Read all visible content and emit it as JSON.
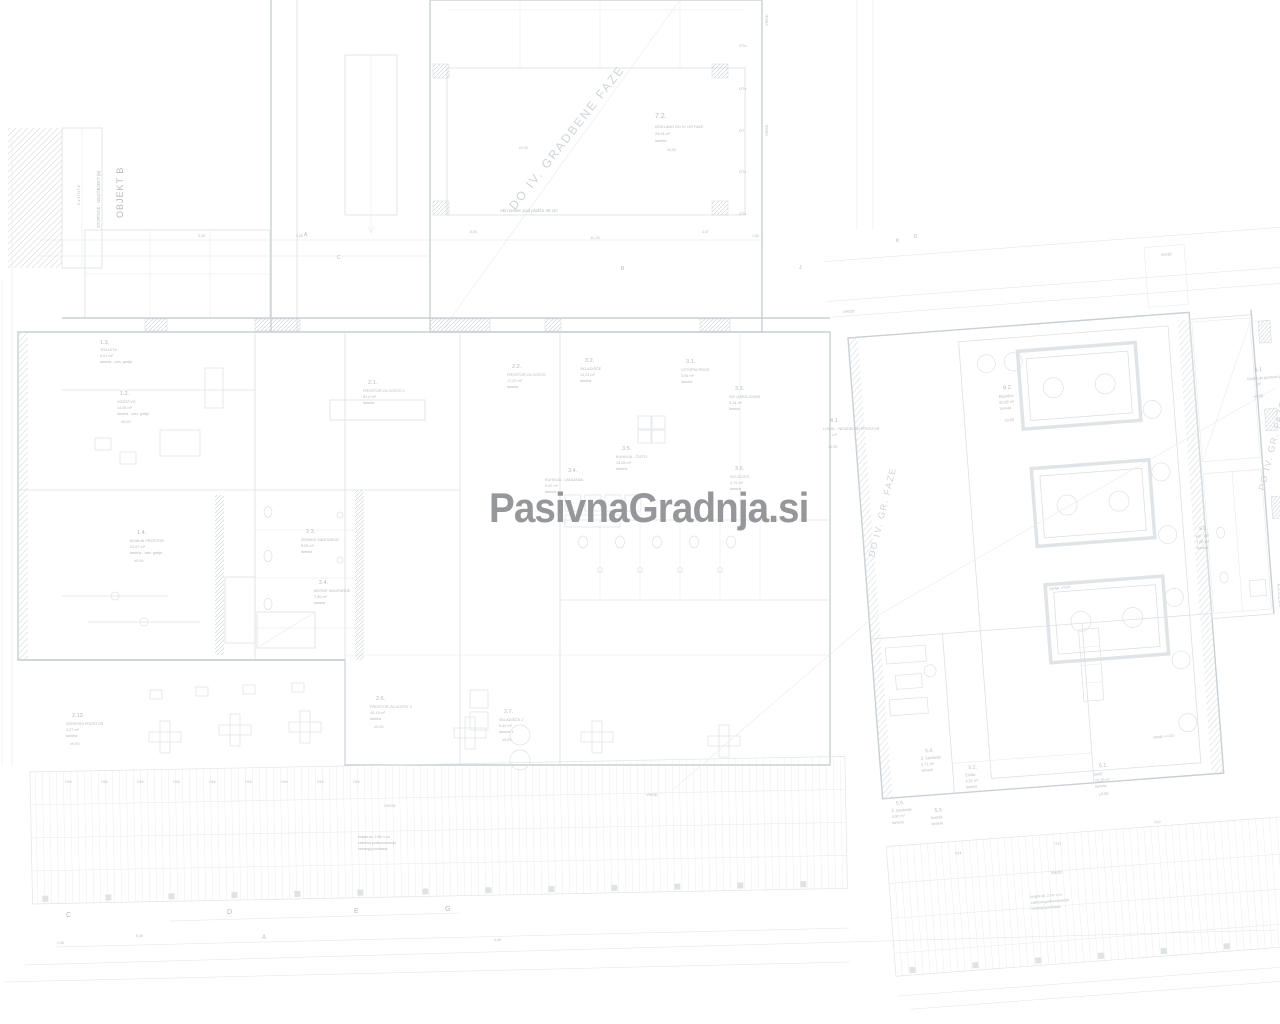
{
  "watermark": {
    "text": "PasivnaGradnja.si",
    "color": "#95979a"
  },
  "plan": {
    "background_color": "#ffffff",
    "wall_color": "#c9cfd4",
    "partition_color": "#dbe0e4",
    "label_color": "#b4bac0",
    "phase_text_color": "#ced4d9",
    "labels": [
      {
        "t": "OBJEKT B",
        "x": 123,
        "y": 218,
        "s": 9,
        "r": -90,
        "w": 1
      },
      {
        "t": "STOPNICE - OBJ/OBJEKT (B)",
        "x": 100,
        "y": 228,
        "s": 4.2,
        "r": -90
      },
      {
        "t": "9 x 17/17,8",
        "x": 80,
        "y": 205,
        "s": 4,
        "r": -90
      },
      {
        "t": "DO IV. GRADBENE FAZE",
        "x": 570,
        "y": 140,
        "s": 12,
        "r": -52,
        "c": "#ced4d9",
        "w": 2,
        "a": "middle"
      },
      {
        "t": "7.2.",
        "x": 655,
        "y": 118,
        "s": 7
      },
      {
        "t": "IZDELANO DO IV. GR FAZE",
        "x": 655,
        "y": 128
      },
      {
        "t": "29,04 m²",
        "x": 655,
        "y": 135
      },
      {
        "t": "lamela",
        "x": 655,
        "y": 142
      },
      {
        "t": "AB nosilec pod ploščo 45 cm",
        "x": 500,
        "y": 212,
        "s": 4.5
      },
      {
        "t": "11,15",
        "x": 590,
        "y": 239,
        "s": 4
      },
      {
        "t": "5,00",
        "x": 470,
        "y": 233,
        "s": 3.5
      },
      {
        "t": "4,67",
        "x": 702,
        "y": 233,
        "s": 3.5
      },
      {
        "t": "1,50",
        "x": 752,
        "y": 237,
        "s": 3.5
      },
      {
        "t": "3,08",
        "x": 296,
        "y": 237,
        "s": 3.5
      },
      {
        "t": "2,30",
        "x": 198,
        "y": 237,
        "s": 3.5
      },
      {
        "t": "±0,00",
        "x": 519,
        "y": 149,
        "s": 3.5
      },
      {
        "t": "±0,00",
        "x": 667,
        "y": 151,
        "s": 3.5
      },
      {
        "t": "O7s",
        "x": 739,
        "y": 47,
        "s": 4
      },
      {
        "t": "O7s",
        "x": 739,
        "y": 90,
        "s": 4
      },
      {
        "t": "O7",
        "x": 739,
        "y": 132,
        "s": 4
      },
      {
        "t": "O7s",
        "x": 739,
        "y": 173,
        "s": 4
      },
      {
        "t": "O7s",
        "x": 739,
        "y": 215,
        "s": 4
      },
      {
        "t": "VHOD",
        "x": 768,
        "y": 26,
        "s": 4,
        "r": -90
      },
      {
        "t": "VHOD",
        "x": 768,
        "y": 136,
        "s": 4,
        "r": -90
      },
      {
        "t": "A",
        "x": 304,
        "y": 236,
        "s": 5
      },
      {
        "t": "C",
        "x": 337,
        "y": 259,
        "s": 5
      },
      {
        "t": "B",
        "x": 621,
        "y": 270,
        "s": 5
      },
      {
        "t": "J",
        "x": 799,
        "y": 269,
        "s": 5
      },
      {
        "t": "1.3.",
        "x": 100,
        "y": 344,
        "s": 5.5
      },
      {
        "t": "TOALETA",
        "x": 100,
        "y": 351
      },
      {
        "t": "5,01 m²",
        "x": 100,
        "y": 357
      },
      {
        "t": "lamela - taln. gretje",
        "x": 100,
        "y": 363
      },
      {
        "t": "1.2.",
        "x": 120,
        "y": 395,
        "s": 5.5
      },
      {
        "t": "VODSTVO",
        "x": 117,
        "y": 403
      },
      {
        "t": "14,05 m²",
        "x": 117,
        "y": 409
      },
      {
        "t": "lamela - taln. gretje",
        "x": 117,
        "y": 415
      },
      {
        "t": "±0,00",
        "x": 121,
        "y": 423
      },
      {
        "t": "2.1.",
        "x": 368,
        "y": 384,
        "s": 5.5
      },
      {
        "t": "PROSTOR ZA GOSTE 1",
        "x": 363,
        "y": 392
      },
      {
        "t": "81,9 m²",
        "x": 363,
        "y": 398
      },
      {
        "t": "lamela",
        "x": 363,
        "y": 404
      },
      {
        "t": "2.2.",
        "x": 512,
        "y": 368,
        "s": 5.5
      },
      {
        "t": "PROSTOR ZA GOSTE",
        "x": 507,
        "y": 376
      },
      {
        "t": "17,22 m²",
        "x": 507,
        "y": 382
      },
      {
        "t": "lamela",
        "x": 507,
        "y": 388
      },
      {
        "t": "1.4.",
        "x": 137,
        "y": 534,
        "s": 5.5
      },
      {
        "t": "BIVALNI PROSTOR",
        "x": 130,
        "y": 542
      },
      {
        "t": "22,67 m²",
        "x": 130,
        "y": 548
      },
      {
        "t": "lamela - taln. gretje",
        "x": 130,
        "y": 554
      },
      {
        "t": "±0,00",
        "x": 134,
        "y": 562
      },
      {
        "t": "2.3.",
        "x": 306,
        "y": 533,
        "s": 5.5
      },
      {
        "t": "ŽENSKE SANITARIJE",
        "x": 301,
        "y": 541
      },
      {
        "t": "8,05 m²",
        "x": 301,
        "y": 547
      },
      {
        "t": "lamela",
        "x": 301,
        "y": 553
      },
      {
        "t": "2.4.",
        "x": 319,
        "y": 584,
        "s": 5.5
      },
      {
        "t": "MOŠKE SANITARIJE",
        "x": 314,
        "y": 592
      },
      {
        "t": "7,50 m²",
        "x": 314,
        "y": 598
      },
      {
        "t": "lamela",
        "x": 314,
        "y": 604
      },
      {
        "t": "3.2.",
        "x": 585,
        "y": 362,
        "s": 5.5
      },
      {
        "t": "SKLADIŠČE",
        "x": 580,
        "y": 370
      },
      {
        "t": "12,21 m²",
        "x": 580,
        "y": 376
      },
      {
        "t": "lamela",
        "x": 580,
        "y": 382
      },
      {
        "t": "3.1.",
        "x": 686,
        "y": 363,
        "s": 5.5
      },
      {
        "t": "VSTOPNI PROS.",
        "x": 681,
        "y": 371
      },
      {
        "t": "3,06 m²",
        "x": 681,
        "y": 377
      },
      {
        "t": "lamela",
        "x": 681,
        "y": 383
      },
      {
        "t": "3.3.",
        "x": 735,
        "y": 390,
        "s": 5.5
      },
      {
        "t": "WC GARD./OSEB.",
        "x": 729,
        "y": 398
      },
      {
        "t": "3,14 m²",
        "x": 729,
        "y": 404
      },
      {
        "t": "lamela",
        "x": 729,
        "y": 410
      },
      {
        "t": "3.5.",
        "x": 622,
        "y": 450,
        "s": 5.5
      },
      {
        "t": "KUHINJA - ČISTO",
        "x": 616,
        "y": 458
      },
      {
        "t": "13,05 m²",
        "x": 616,
        "y": 464
      },
      {
        "t": "lamela",
        "x": 616,
        "y": 470
      },
      {
        "t": "3.4.",
        "x": 568,
        "y": 472,
        "s": 5.5
      },
      {
        "t": "KUHINJA - UMAZANA",
        "x": 545,
        "y": 481
      },
      {
        "t": "9,42 m²",
        "x": 545,
        "y": 487
      },
      {
        "t": "lamela",
        "x": 545,
        "y": 493
      },
      {
        "t": "3.6.",
        "x": 735,
        "y": 470,
        "s": 5.5
      },
      {
        "t": "WC-GOSTI",
        "x": 730,
        "y": 478
      },
      {
        "t": "4,70 m²",
        "x": 730,
        "y": 484
      },
      {
        "t": "lamela",
        "x": 730,
        "y": 490
      },
      {
        "t": "4.1.",
        "x": 830,
        "y": 422,
        "s": 5.5
      },
      {
        "t": "LOKAL - NEIZDELAN PROSTOR",
        "x": 823,
        "y": 430
      },
      {
        "t": "- m²",
        "x": 830,
        "y": 436
      },
      {
        "t": "±0,00",
        "x": 828,
        "y": 448
      },
      {
        "t": "2.6.",
        "x": 376,
        "y": 700,
        "s": 5.5
      },
      {
        "t": "PROSTOR ZA GOSTE 2",
        "x": 370,
        "y": 708
      },
      {
        "t": "40,13 m²",
        "x": 370,
        "y": 714
      },
      {
        "t": "lamela",
        "x": 370,
        "y": 720
      },
      {
        "t": "±0,00",
        "x": 374,
        "y": 728
      },
      {
        "t": "2.7.",
        "x": 504,
        "y": 713,
        "s": 5.5
      },
      {
        "t": "SKLADIŠČE 2",
        "x": 499,
        "y": 721
      },
      {
        "t": "5,42 m²",
        "x": 499,
        "y": 727
      },
      {
        "t": "lamela 1",
        "x": 499,
        "y": 733
      },
      {
        "t": "±0,00",
        "x": 502,
        "y": 741
      },
      {
        "t": "2.13.",
        "x": 72,
        "y": 717,
        "s": 5.5
      },
      {
        "t": "SERVISNI PROSTOR",
        "x": 66,
        "y": 725
      },
      {
        "t": "4,27 m²",
        "x": 66,
        "y": 731
      },
      {
        "t": "lamela",
        "x": 66,
        "y": 737
      },
      {
        "t": "±0,00",
        "x": 70,
        "y": 745
      },
      {
        "t": "VHOD",
        "x": 384,
        "y": 807,
        "s": 4
      },
      {
        "t": "VHOD",
        "x": 646,
        "y": 796,
        "s": 4
      },
      {
        "t": "O16",
        "x": 65,
        "y": 783,
        "s": 3.5
      },
      {
        "t": "O15",
        "x": 101,
        "y": 783,
        "s": 3.5
      },
      {
        "t": "O16",
        "x": 137,
        "y": 783,
        "s": 3.5
      },
      {
        "t": "O16",
        "x": 173,
        "y": 783,
        "s": 3.5
      },
      {
        "t": "O15",
        "x": 209,
        "y": 783,
        "s": 3.5
      },
      {
        "t": "O16",
        "x": 245,
        "y": 783,
        "s": 3.5
      },
      {
        "t": "O15",
        "x": 281,
        "y": 783,
        "s": 3.5
      },
      {
        "t": "O16",
        "x": 317,
        "y": 783,
        "s": 3.5
      },
      {
        "t": "O16",
        "x": 353,
        "y": 783,
        "s": 3.5
      },
      {
        "t": "brajda ob. 2,5m v os",
        "x": 358,
        "y": 838,
        "s": 3.5
      },
      {
        "t": "zaščitna podkonstrukcija",
        "x": 358,
        "y": 844,
        "s": 3.5
      },
      {
        "t": "vetrangl pocinkana",
        "x": 358,
        "y": 850,
        "s": 3.5
      },
      {
        "t": "C",
        "x": 66,
        "y": 917,
        "s": 7
      },
      {
        "t": "D",
        "x": 227,
        "y": 914,
        "s": 7
      },
      {
        "t": "E",
        "x": 354,
        "y": 913,
        "s": 7
      },
      {
        "t": "G",
        "x": 445,
        "y": 911,
        "s": 7
      },
      {
        "t": "A",
        "x": 262,
        "y": 939,
        "s": 6
      },
      {
        "t": "4,40",
        "x": 494,
        "y": 941,
        "s": 3.5
      },
      {
        "t": "1,35",
        "x": 57,
        "y": 944,
        "s": 3.5
      },
      {
        "t": "5,45",
        "x": 136,
        "y": 937,
        "s": 3.5
      },
      {
        "t": "9.2.",
        "x": 999,
        "y": 401,
        "s": 5.5,
        "g": "r"
      },
      {
        "t": "Biljardna",
        "x": 994,
        "y": 409,
        "g": "r"
      },
      {
        "t": "60,65 m²",
        "x": 994,
        "y": 415,
        "g": "r"
      },
      {
        "t": "lamela",
        "x": 994,
        "y": 421,
        "g": "r"
      },
      {
        "t": "±0,00",
        "x": 998,
        "y": 433,
        "g": "r"
      },
      {
        "t": "6.1",
        "x": 1251,
        "y": 402,
        "s": 5.5,
        "g": "r"
      },
      {
        "t": "Gostinski poslovni pr.",
        "x": 1243,
        "y": 410,
        "g": "r"
      },
      {
        "t": "- m²",
        "x": 1250,
        "y": 416,
        "g": "r"
      },
      {
        "t": "±0,00",
        "x": 1248,
        "y": 428,
        "g": "r"
      },
      {
        "t": "DO IV. GR. FAZE",
        "x": 872,
        "y": 515,
        "s": 9,
        "r": -72,
        "c": "#ced4d9",
        "w": 1.5,
        "a": "middle",
        "g": "r"
      },
      {
        "t": "DO IV. GR. FAZE",
        "x": 1266,
        "y": 478,
        "s": 9,
        "r": -72,
        "c": "#ced4d9",
        "w": 1.5,
        "a": "middle",
        "g": "r"
      },
      {
        "t": "5.6.",
        "x": 1184,
        "y": 556,
        "s": 5,
        "g": "r"
      },
      {
        "t": "wc - tuš",
        "x": 1180,
        "y": 563,
        "g": "r"
      },
      {
        "t": "7,00 m²",
        "x": 1180,
        "y": 569,
        "g": "r"
      },
      {
        "t": "lamela",
        "x": 1180,
        "y": 575,
        "g": "r"
      },
      {
        "t": "5.4.",
        "x": 894,
        "y": 757,
        "s": 5,
        "g": "r"
      },
      {
        "t": "Ž. Sanitarije",
        "x": 889,
        "y": 764,
        "g": "r"
      },
      {
        "t": "5,71 m²",
        "x": 889,
        "y": 770,
        "g": "r"
      },
      {
        "t": "lamela",
        "x": 889,
        "y": 776,
        "g": "r"
      },
      {
        "t": "5.2.",
        "x": 936,
        "y": 777,
        "s": 5,
        "g": "r"
      },
      {
        "t": "Čistila",
        "x": 932,
        "y": 784,
        "g": "r"
      },
      {
        "t": "4,51 m²",
        "x": 932,
        "y": 790,
        "g": "r"
      },
      {
        "t": "lamela",
        "x": 932,
        "y": 796,
        "g": "r"
      },
      {
        "t": "5.5.",
        "x": 861,
        "y": 807,
        "s": 5,
        "g": "r"
      },
      {
        "t": "Ž. Sanitarije",
        "x": 856,
        "y": 814,
        "g": "r"
      },
      {
        "t": "4,92 m²",
        "x": 856,
        "y": 820,
        "g": "r"
      },
      {
        "t": "lamela",
        "x": 856,
        "y": 826,
        "g": "r"
      },
      {
        "t": "5.3.",
        "x": 899,
        "y": 817,
        "s": 5,
        "g": "r"
      },
      {
        "t": "hodnik",
        "x": 895,
        "y": 824,
        "g": "r"
      },
      {
        "t": "lamela",
        "x": 895,
        "y": 830,
        "g": "r"
      },
      {
        "t": "5.1.",
        "x": 1066,
        "y": 785,
        "s": 5.5,
        "g": "r"
      },
      {
        "t": "BAR",
        "x": 1061,
        "y": 793,
        "g": "r"
      },
      {
        "t": "72,20 m²",
        "x": 1061,
        "y": 799,
        "g": "r"
      },
      {
        "t": "lamela",
        "x": 1061,
        "y": 805,
        "g": "r"
      },
      {
        "t": "±0,00",
        "x": 1064,
        "y": 813,
        "g": "r"
      },
      {
        "t": "VHOD",
        "x": 1166,
        "y": 280,
        "s": 4,
        "g": "r"
      },
      {
        "t": "VHOD",
        "x": 845,
        "y": 313,
        "s": 4,
        "g": "r"
      },
      {
        "t": "VHOD",
        "x": 1010,
        "y": 888,
        "s": 4,
        "g": "r"
      },
      {
        "t": "ograja, v=110",
        "x": 1030,
        "y": 604,
        "s": 3.5,
        "g": "r"
      },
      {
        "t": "ograja, v=110",
        "x": 1122,
        "y": 760,
        "s": 3.5,
        "g": "r"
      },
      {
        "t": "K",
        "x": 903,
        "y": 246,
        "s": 5,
        "g": "r"
      },
      {
        "t": "G",
        "x": 921,
        "y": 243,
        "s": 5,
        "g": "r"
      },
      {
        "t": "O14",
        "x": 916,
        "y": 861,
        "s": 3.5,
        "g": "r"
      },
      {
        "t": "O13",
        "x": 1016,
        "y": 859,
        "s": 3.5,
        "g": "r"
      },
      {
        "t": "O12",
        "x": 1117,
        "y": 845,
        "s": 3.5,
        "g": "r"
      },
      {
        "t": "O11",
        "x": 1257,
        "y": 833,
        "s": 3.5,
        "g": "r"
      },
      {
        "t": "brajda ob. 2,5m v os",
        "x": 988,
        "y": 910,
        "s": 3.5,
        "g": "r"
      },
      {
        "t": "zaščitna podkonstrukcija",
        "x": 988,
        "y": 916,
        "s": 3.5,
        "g": "r"
      },
      {
        "t": "vetrangl pocinkana",
        "x": 988,
        "y": 922,
        "s": 3.5,
        "g": "r"
      }
    ]
  }
}
